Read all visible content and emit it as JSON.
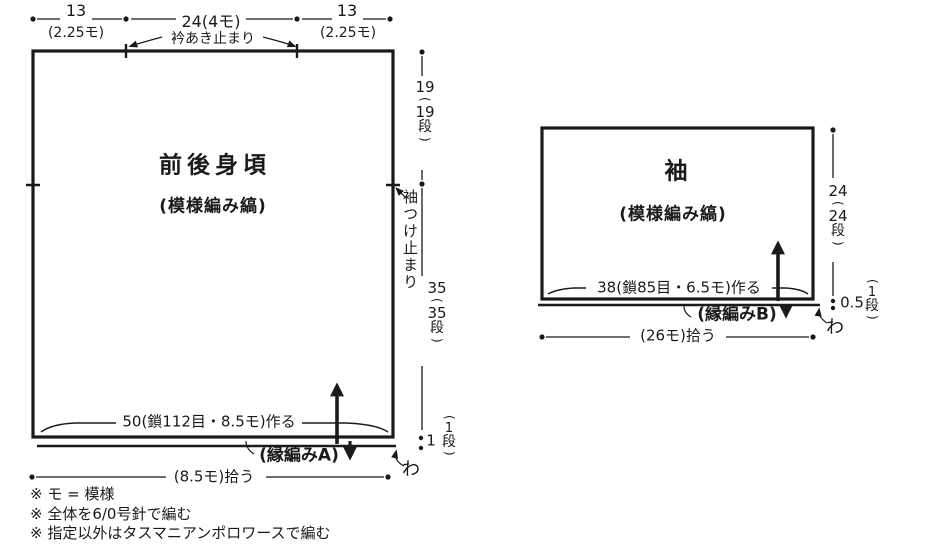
{
  "punct": {
    "open": "(",
    "close": ")"
  },
  "body": {
    "title": "前後身頃",
    "pattern": "(模様編み縞)",
    "top": {
      "left_cm": "13",
      "left_pattern": "(2.25モ)",
      "center": "24(4モ)",
      "neck_label": "衿あき止まり",
      "right_cm": "13",
      "right_pattern": "(2.25モ)"
    },
    "right": {
      "upper": {
        "cm": "19",
        "rows": "19",
        "unit": "段"
      },
      "armhole_label": "袖つけ止まり",
      "lower": {
        "cm": "35",
        "rows": "35",
        "unit": "段"
      },
      "edge": {
        "cm": "1",
        "rows": "1",
        "unit": "段"
      }
    },
    "cast_on": "50(鎖112目・8.5モ)作る",
    "edging": "(縁編みA)",
    "pickup": "(8.5モ)拾う",
    "round": "わ"
  },
  "sleeve": {
    "title": "袖",
    "pattern": "(模様編み縞)",
    "height": {
      "cm": "24",
      "rows": "24",
      "unit": "段"
    },
    "edge": {
      "cm": "0.5",
      "rows": "1",
      "unit": "段"
    },
    "cast_on": "38(鎖85目・6.5モ)作る",
    "edging": "(縁編みB)",
    "pickup": "(26モ)拾う",
    "round": "わ"
  },
  "notes": {
    "line1": "※ モ = 模様",
    "line2": "※ 全体を6/0号針で編む",
    "line3": "※ 指定以外はタスマニアンポロワースで編む"
  },
  "colors": {
    "ink": "#1a1a1a",
    "background": "#ffffff"
  }
}
